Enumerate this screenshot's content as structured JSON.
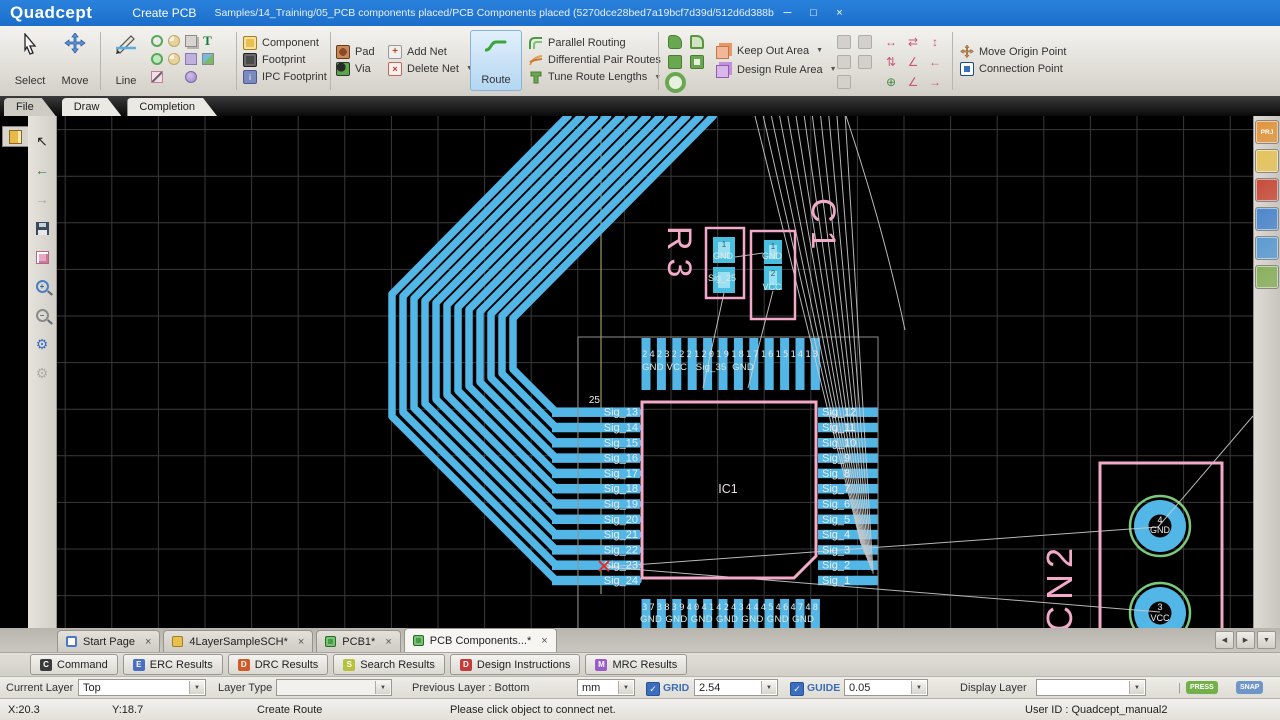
{
  "titlebar": {
    "logo": "Quadcept",
    "menus": [
      "File",
      "Edit",
      "Draw",
      "Create PCB",
      "Project",
      "Window",
      "Settings"
    ],
    "document_path": "Samples/14_Training/05_PCB components placed/PCB Components placed (5270dce28bed7a19bcf7d39d/512d6d388bed7a09489d84f9)*",
    "minimize": "─",
    "maximize": "□",
    "close": "×"
  },
  "ribbon_tabs": [
    {
      "label": "File",
      "active": false
    },
    {
      "label": "Draw",
      "active": true
    },
    {
      "label": "Completion",
      "active": true
    }
  ],
  "ribbon": {
    "select": "Select",
    "move": "Move",
    "line": "Line",
    "component": "Component",
    "footprint": "Footprint",
    "ipc_footprint": "IPC Footprint",
    "pad": "Pad",
    "via": "Via",
    "add_net": "Add Net",
    "delete_net": "Delete Net",
    "route": "Route",
    "parallel_routing": "Parallel Routing",
    "differential_pair_routes": "Differential Pair Routes",
    "tune_route_lengths": "Tune Route Lengths",
    "keep_out_area": "Keep Out Area",
    "design_rule_area": "Design Rule Area",
    "move_origin_point": "Move Origin Point",
    "connection_point": "Connection Point"
  },
  "left_toolbar": [
    "select",
    "undo",
    "redo",
    "save",
    "footprint",
    "zoom-in",
    "zoom-out",
    "settings",
    "settings-alt"
  ],
  "right_toolbar": [
    {
      "name": "project-panel",
      "label": "PRJ",
      "color": "#e2953c"
    },
    {
      "name": "component-panel",
      "label": "",
      "color": "#e6c35a"
    },
    {
      "name": "layer-panel",
      "label": "",
      "color": "#c84a38"
    },
    {
      "name": "net-panel",
      "label": "",
      "color": "#4a86cc"
    },
    {
      "name": "parts-panel",
      "label": "",
      "color": "#5a9ad2"
    },
    {
      "name": "preview-panel",
      "label": "",
      "color": "#88b05c"
    }
  ],
  "pcb": {
    "ic1": {
      "ref": "IC1",
      "corner_pin": "25",
      "left_pins": [
        "Sig_13",
        "Sig_14",
        "Sig_15",
        "Sig_16",
        "Sig_17",
        "Sig_18",
        "Sig_19",
        "Sig_20",
        "Sig_21",
        "Sig_22",
        "Sig_23",
        "Sig_24"
      ],
      "right_pins": [
        "Sig_12",
        "Sig_11",
        "Sig_10",
        "Sig_9",
        "Sig_8",
        "Sig_7",
        "Sig_6",
        "Sig_5",
        "Sig_4",
        "Sig_3",
        "Sig_2",
        "Sig_1"
      ],
      "top_numbers": "242322212019181716151413",
      "top_nets": "GND VCC   Sig_35  GND",
      "bottom_numbers": "373839404142434445464748",
      "bottom_nets": "GND GND GND GND GND GND GND"
    },
    "r3": {
      "ref": "R3",
      "pin1_num": "1",
      "pin1_net": "GND",
      "pin2_net": "Sig_25"
    },
    "c1": {
      "ref": "C1",
      "pin1_num": "1",
      "pin1_net": "GND",
      "pin2_num": "2",
      "pin2_net": "VCC"
    },
    "cn2": {
      "ref": "CN2",
      "pin4_num": "4",
      "pin4_net": "GND",
      "pin3_num": "3",
      "pin3_net": "VCC"
    }
  },
  "doc_tabs": [
    {
      "label": "Start Page",
      "icon": "start",
      "active": false
    },
    {
      "label": "4LayerSampleSCH*",
      "icon": "sch",
      "active": false
    },
    {
      "label": "PCB1*",
      "icon": "pcb",
      "active": false
    },
    {
      "label": "PCB Components...*",
      "icon": "pcb",
      "active": true
    }
  ],
  "panel_tabs": [
    {
      "label": "Command",
      "color": "#3a3a3a"
    },
    {
      "label": "ERC Results",
      "color": "#4a6fc0"
    },
    {
      "label": "DRC Results",
      "color": "#d05a28"
    },
    {
      "label": "Search Results",
      "color": "#b6c23c"
    },
    {
      "label": "Design Instructions",
      "color": "#c43a3a"
    },
    {
      "label": "MRC Results",
      "color": "#9a5ac8"
    }
  ],
  "settings_bar": {
    "current_layer_label": "Current Layer",
    "current_layer_value": "Top",
    "layer_type_label": "Layer Type",
    "layer_type_value": "",
    "previous_layer": "Previous Layer : Bottom",
    "unit_value": "mm",
    "grid_label": "GRID",
    "grid_value": "2.54",
    "guide_label": "GUIDE",
    "guide_value": "0.05",
    "display_layer_label": "Display Layer",
    "display_layer_value": "",
    "badges": [
      {
        "label": "PRESS",
        "color": "#74b04a"
      },
      {
        "label": "SNAP",
        "color": "#6f96c8"
      },
      {
        "label": "FILTER",
        "color": "#a8a6a0"
      }
    ]
  },
  "statusbar": {
    "x": "X:20.3",
    "y": "Y:18.7",
    "mode": "Create Route",
    "message": "Please click object to connect net.",
    "user_id": "User ID : Quadcept_manual2"
  },
  "colors": {
    "trace": "#52b6e6",
    "outline": "#f2aac8",
    "ratsnest": "#cccccc",
    "guide": "#9a9a5f",
    "grid": "#3a3a3a"
  }
}
